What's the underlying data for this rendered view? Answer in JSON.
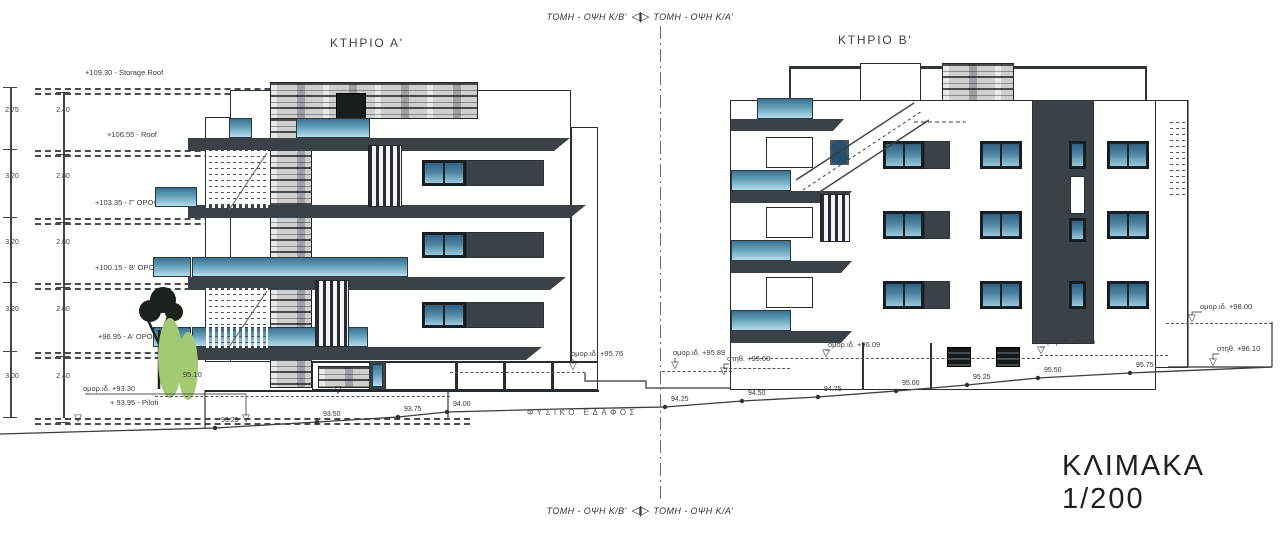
{
  "titles": {
    "section_top_left": "ΤΟΜΗ - ΟΨΗ Κ/Β'",
    "section_top_right": "ΤΟΜΗ - ΟΨΗ Κ/Α'",
    "section_bottom_left": "ΤΟΜΗ - ΟΨΗ Κ/Β'",
    "section_bottom_right": "ΤΟΜΗ - ΟΨΗ Κ/Α'",
    "building_a": "ΚΤΗΡΙΟ Α'",
    "building_b": "ΚΤΗΡΙΟ Β'",
    "scale": "ΚΛΙΜΑΚΑ 1/200",
    "natural_ground": "ΦΥΣΙΚΟ ΕΔΑΦΟΣ"
  },
  "icons": {
    "level_marker": "▽",
    "section_cut": "◁|▷"
  },
  "colors": {
    "charcoal": "#3a4147",
    "glass_top": "#316082",
    "glass_bottom": "#9cc9dc",
    "greenery": "#a4c973"
  },
  "levels": [
    {
      "label": "+109.30 - Storage Roof",
      "y": 88,
      "lx": 85
    },
    {
      "label": "+106.55 - Roof",
      "y": 150,
      "lx": 107
    },
    {
      "label": "+103.35 - Γ' ΟΡΟΦΟΣ",
      "y": 218,
      "lx": 95
    },
    {
      "label": "+100.15 - Β' ΟΡΟΦΟΣ",
      "y": 283,
      "lx": 95
    },
    {
      "label": "+96.95 - Α' ΟΡΟΦΟΣ",
      "y": 352,
      "lx": 98
    },
    {
      "label": "+ 93.95 - Piloti",
      "y": 418,
      "lx": 110
    }
  ],
  "dimensions": {
    "outer": [
      {
        "v": "2.75",
        "y": 112
      },
      {
        "v": "3.20",
        "y": 178
      },
      {
        "v": "3.20",
        "y": 244
      },
      {
        "v": "3.20",
        "y": 311
      },
      {
        "v": "3.00",
        "y": 378
      }
    ],
    "inner": [
      {
        "v": "2.40",
        "y": 112
      },
      {
        "v": "2.80",
        "y": 178
      },
      {
        "v": "2.80",
        "y": 244
      },
      {
        "v": "2.80",
        "y": 311
      },
      {
        "v": "2.40",
        "y": 378
      }
    ]
  },
  "spot_levels": [
    {
      "label": "ομορ.ιδ. +93.30",
      "x": 83,
      "y": 384,
      "tx": 246,
      "ty": 414
    },
    {
      "label": "95.10",
      "x": 183,
      "y": 370
    },
    {
      "label": "ομορ.ιδ. +95.76",
      "x": 571,
      "y": 349,
      "tx": 573,
      "ty": 362
    },
    {
      "label": "ομορ.ιδ. +95.89",
      "x": 673,
      "y": 348,
      "tx": 675,
      "ty": 361
    },
    {
      "label": "στηθ. +95.60",
      "x": 727,
      "y": 354,
      "tx": 724,
      "ty": 367
    },
    {
      "label": "ομορ.ιδ. +96.09",
      "x": 828,
      "y": 340,
      "tx": 826,
      "ty": 349
    },
    {
      "label": "ομορ.ιδ. +96.26",
      "x": 1043,
      "y": 337,
      "tx": 1041,
      "ty": 346
    },
    {
      "label": "ομορ.ιδ. +98.00",
      "x": 1200,
      "y": 302,
      "tx": 1192,
      "ty": 314
    },
    {
      "label": "στηθ. +96.10",
      "x": 1217,
      "y": 344,
      "tx": 1213,
      "ty": 358
    }
  ],
  "markers": [
    {
      "x": 78,
      "y": 414
    },
    {
      "x": 338,
      "y": 386
    }
  ],
  "ground_points": [
    {
      "label": "93.25",
      "x": 215,
      "y": 428
    },
    {
      "label": "93.50",
      "x": 317,
      "y": 422
    },
    {
      "label": "93.75",
      "x": 398,
      "y": 417
    },
    {
      "label": "94.00",
      "x": 447,
      "y": 412
    },
    {
      "label": "94.25",
      "x": 665,
      "y": 407
    },
    {
      "label": "94.50",
      "x": 742,
      "y": 401
    },
    {
      "label": "94.75",
      "x": 818,
      "y": 397
    },
    {
      "label": "95.00",
      "x": 896,
      "y": 391
    },
    {
      "label": "95.25",
      "x": 967,
      "y": 385
    },
    {
      "label": "95.50",
      "x": 1038,
      "y": 378
    },
    {
      "label": "95.75",
      "x": 1130,
      "y": 373
    }
  ],
  "ground_line": [
    [
      0,
      434
    ],
    [
      70,
      432
    ],
    [
      215,
      428
    ],
    [
      317,
      422
    ],
    [
      398,
      417
    ],
    [
      447,
      412
    ],
    [
      560,
      409
    ],
    [
      665,
      407
    ],
    [
      742,
      401
    ],
    [
      818,
      397
    ],
    [
      896,
      391
    ],
    [
      967,
      385
    ],
    [
      1038,
      378
    ],
    [
      1130,
      373
    ],
    [
      1272,
      367
    ]
  ]
}
